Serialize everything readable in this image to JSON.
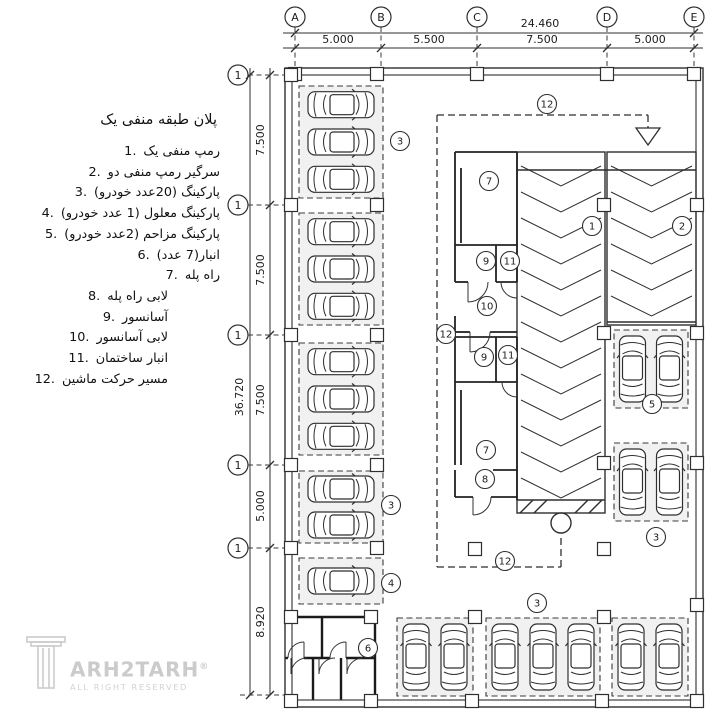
{
  "legend": {
    "title": "پلان طبقه منفی یک",
    "items": [
      {
        "num": "1.",
        "label": "رمپ منفی یک"
      },
      {
        "num": "2.",
        "label": "سرگیر رمپ منفی دو"
      },
      {
        "num": "3.",
        "label": "پارکینگ (20عدد خودرو)"
      },
      {
        "num": "4.",
        "label": "پارکینگ معلول (1 عدد خودرو)"
      },
      {
        "num": "5.",
        "label": "پارکینگ مزاحم (2عدد خودرو)"
      },
      {
        "num": "6.",
        "label": "انبار(7 عدد)"
      },
      {
        "num": "7.",
        "label": "راه پله"
      },
      {
        "num": "8.",
        "label": "لابی راه پله"
      },
      {
        "num": "9.",
        "label": "آسانسور"
      },
      {
        "num": "10.",
        "label": "لابی آسانسور"
      },
      {
        "num": "11.",
        "label": "انبار ساختمان"
      },
      {
        "num": "12.",
        "label": "مسیر حرکت ماشین"
      }
    ]
  },
  "watermark": {
    "brand": "ARH2TARH",
    "reg": "®",
    "sub": "ALL RIGHT RESERVED"
  },
  "plan": {
    "colors": {
      "line": "#2f2f2f",
      "dash": "#3a3a3a",
      "bay": "#f1f1f1",
      "wm": "#cccccc"
    },
    "top_grid": {
      "yBub": 17,
      "r": 10,
      "yTotal": 33,
      "ySeg": 48,
      "x0": 283,
      "x1": 703,
      "extEnd": 68,
      "total": {
        "label": "24.460",
        "x": 540
      },
      "cols": [
        {
          "label": "A",
          "x": 295
        },
        {
          "label": "B",
          "x": 381
        },
        {
          "label": "C",
          "x": 477
        },
        {
          "label": "D",
          "x": 607
        },
        {
          "label": "E",
          "x": 694
        }
      ],
      "segments": [
        {
          "label": "5.000",
          "x": 338
        },
        {
          "label": "5.500",
          "x": 429
        },
        {
          "label": "7.500",
          "x": 542
        },
        {
          "label": "5.000",
          "x": 650
        }
      ]
    },
    "left_grid": {
      "xBub": 238,
      "r": 10,
      "xTotal": 250,
      "xSeg": 270,
      "y0": 68,
      "y1": 695,
      "extEnd": 285,
      "total": {
        "label": "36.720",
        "x": 243,
        "y": 397
      },
      "rows": [
        {
          "label": "1",
          "y": 75
        },
        {
          "label": "1",
          "y": 205
        },
        {
          "label": "1",
          "y": 335
        },
        {
          "label": "1",
          "y": 465
        },
        {
          "label": "1",
          "y": 548
        }
      ],
      "segments": [
        {
          "label": "7.500",
          "y": 140
        },
        {
          "label": "7.500",
          "y": 270
        },
        {
          "label": "7.500",
          "y": 400
        },
        {
          "label": "5.000",
          "y": 506
        },
        {
          "label": "8.920",
          "y": 622
        }
      ]
    },
    "building": {
      "outer": [
        285,
        68,
        418,
        639
      ],
      "inner": [
        292,
        75,
        404,
        625
      ]
    },
    "ramp": {
      "lanes": [
        {
          "x1": 517,
          "y1": 152,
          "x2": 605,
          "y2": 513,
          "cy0": 166,
          "cy1": 492,
          "step": 26,
          "drop": 20
        },
        {
          "x1": 607,
          "y1": 152,
          "x2": 696,
          "y2": 325,
          "cy0": 166,
          "cy1": 302,
          "step": 26,
          "drop": 20
        }
      ],
      "lines": [
        "M517 170 H696",
        "M607 322 H696",
        "M517 500 H605",
        "M520 513 L533 500",
        "M534 513 L547 500",
        "M575 513 L588 500",
        "M589 513 L602 500"
      ],
      "circle": {
        "cx": 561,
        "cy": 523,
        "r": 10
      }
    },
    "cores": {
      "walls": [
        "M455 152 H517",
        "M455 152 V245",
        "M517 152 V282",
        "M455 245 H517",
        "M455 245 V282",
        "M496 245 V282",
        "M461 168 V243",
        "M455 282 H468",
        "M496 282 H517",
        "M455 316 V332",
        "M455 332 H470",
        "M490 332 H517",
        "M455 337 H517",
        "M455 337 V382",
        "M517 337 V500",
        "M496 337 V382",
        "M455 382 H517",
        "M455 382 V465",
        "M461 390 V465",
        "M493 470 H517",
        "M455 470 V497",
        "M455 497 H473",
        "M491 497 H517"
      ],
      "doors": [
        "M468 282 V302",
        "M488 282 A20 20 0 0 1 468 302",
        "M517 284 V298",
        "M501 282 A16 16 0 0 0 517 298",
        "M470 332 V352",
        "M490 332 A20 20 0 0 1 470 352",
        "M517 382 V397",
        "M502 382 A15 15 0 0 0 517 397",
        "M473 497 V515",
        "M491 497 A18 18 0 0 1 473 515"
      ]
    },
    "storage": {
      "walls": [
        "M285 617 H375",
        "M375 617 V700",
        "M322 617 V658",
        "M285 658 H288",
        "M304 658 H330",
        "M346 658 H375",
        "M313 658 V700",
        "M341 658 V700"
      ],
      "doors": [
        "M304 658 V642",
        "M288 658 A16 16 0 0 1 304 642",
        "M346 658 V642",
        "M330 658 A16 16 0 0 1 346 642",
        "M291 658 V674",
        "M307 658 A16 16 0 0 0 291 674",
        "M319 658 V674",
        "M335 658 A16 16 0 0 0 319 674",
        "M347 658 V674",
        "M363 658 A16 16 0 0 0 347 674"
      ]
    },
    "route": {
      "lines": [
        "M437 115 H648",
        "M648 115 V128",
        "M437 115 V567",
        "M437 567 H561",
        "M561 567 V534"
      ],
      "arrow": "636,128 660,128 648,145"
    },
    "bays": [
      {
        "x": 299,
        "y": 86,
        "w": 84,
        "h": 112,
        "cars": 3,
        "o": "h"
      },
      {
        "x": 299,
        "y": 213,
        "w": 84,
        "h": 112,
        "cars": 3,
        "o": "h"
      },
      {
        "x": 299,
        "y": 343,
        "w": 84,
        "h": 112,
        "cars": 3,
        "o": "h"
      },
      {
        "x": 299,
        "y": 471,
        "w": 84,
        "h": 72,
        "cars": 2,
        "o": "h"
      },
      {
        "x": 299,
        "y": 558,
        "w": 84,
        "h": 46,
        "cars": 1,
        "o": "h"
      },
      {
        "x": 614,
        "y": 330,
        "w": 74,
        "h": 78,
        "cars": 2,
        "o": "v"
      },
      {
        "x": 614,
        "y": 443,
        "w": 74,
        "h": 78,
        "cars": 2,
        "o": "v"
      },
      {
        "x": 397,
        "y": 618,
        "w": 76,
        "h": 78,
        "cars": 2,
        "o": "v"
      },
      {
        "x": 486,
        "y": 618,
        "w": 114,
        "h": 78,
        "cars": 3,
        "o": "v"
      },
      {
        "x": 612,
        "y": 618,
        "w": 76,
        "h": 78,
        "cars": 2,
        "o": "v"
      }
    ],
    "columns": [
      [
        295,
        74
      ],
      [
        377,
        74
      ],
      [
        477,
        74
      ],
      [
        607,
        74
      ],
      [
        694,
        74
      ],
      [
        291,
        75
      ],
      [
        291,
        205
      ],
      [
        291,
        335
      ],
      [
        291,
        465
      ],
      [
        291,
        548
      ],
      [
        291,
        617
      ],
      [
        291,
        701
      ],
      [
        377,
        205
      ],
      [
        377,
        335
      ],
      [
        377,
        465
      ],
      [
        377,
        548
      ],
      [
        371,
        617
      ],
      [
        371,
        701
      ],
      [
        475,
        549
      ],
      [
        604,
        549
      ],
      [
        475,
        617
      ],
      [
        604,
        617
      ],
      [
        472,
        701
      ],
      [
        602,
        701
      ],
      [
        604,
        205
      ],
      [
        604,
        333
      ],
      [
        604,
        463
      ],
      [
        697,
        205
      ],
      [
        697,
        333
      ],
      [
        697,
        463
      ],
      [
        697,
        605
      ],
      [
        697,
        701
      ]
    ],
    "refs": [
      {
        "n": "3",
        "x": 400,
        "y": 141
      },
      {
        "n": "12",
        "x": 547,
        "y": 104
      },
      {
        "n": "7",
        "x": 489,
        "y": 181
      },
      {
        "n": "1",
        "x": 592,
        "y": 226
      },
      {
        "n": "2",
        "x": 682,
        "y": 226
      },
      {
        "n": "9",
        "x": 486,
        "y": 261
      },
      {
        "n": "11",
        "x": 510,
        "y": 261
      },
      {
        "n": "10",
        "x": 487,
        "y": 306
      },
      {
        "n": "12",
        "x": 446,
        "y": 334
      },
      {
        "n": "9",
        "x": 484,
        "y": 357
      },
      {
        "n": "11",
        "x": 508,
        "y": 355
      },
      {
        "n": "5",
        "x": 652,
        "y": 404
      },
      {
        "n": "3",
        "x": 391,
        "y": 505
      },
      {
        "n": "7",
        "x": 486,
        "y": 450
      },
      {
        "n": "8",
        "x": 485,
        "y": 479
      },
      {
        "n": "3",
        "x": 656,
        "y": 537
      },
      {
        "n": "12",
        "x": 505,
        "y": 561
      },
      {
        "n": "4",
        "x": 391,
        "y": 583
      },
      {
        "n": "3",
        "x": 537,
        "y": 603
      },
      {
        "n": "6",
        "x": 368,
        "y": 648
      }
    ]
  }
}
